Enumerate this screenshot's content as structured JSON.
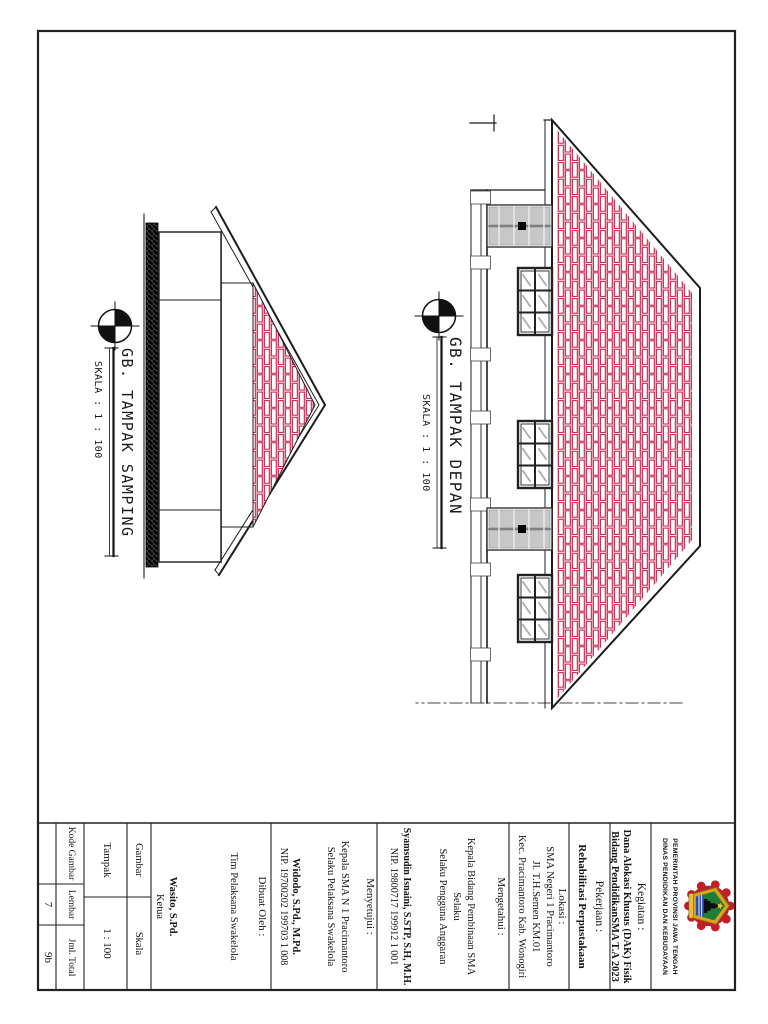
{
  "titleblock": {
    "agency": {
      "line1": "PEMERINTAH PROVINSI JAWA TENGAH",
      "line2": "DINAS PENDIDIKAN DAN KEBUDAYAAN"
    },
    "kegiatan": {
      "label": "Kegiatan :",
      "line1": "Dana Alokasi Khusus (DAK) Fisik",
      "line2": "Bidang PendidikanSMA T.A 2023"
    },
    "pekerjaan": {
      "label": "Pekerjaan :",
      "value": "Rehabilitasi Perpustakaan"
    },
    "lokasi": {
      "label": "Lokasi :",
      "line1": "SMA Negeri 1 Pracimantoro",
      "line2": "Jl. T.H.Semen KM.01",
      "line3": "Kec. Pracimantoro Kab. Wonogiri"
    },
    "mengetahui": {
      "label": "Mengetahui :",
      "role1": "Kepala Bidang Pembinaan SMA",
      "role2": "Selaku",
      "role3": "Selaku Pengguna Anggaran",
      "name": "Syamsudin Isnaini, S.STP, S.H, M.H.",
      "nip": "NIP. 19800717 199912 1 001"
    },
    "menyetujui": {
      "label": "Menyetujui :",
      "role1": "Kepala SMA N 1 Pracimantoro",
      "role2": "Selaku Pelaksana Swakelola",
      "name": "Widodo, S.Pd., M.Pd.",
      "nip": "NIP. 19700202 199703 1 008"
    },
    "dibuat": {
      "label": "Dibuat Oleh :",
      "team": "Tim Pelaksana Swakelola",
      "name": "Wasito, S.Pd.",
      "role": "Ketua"
    },
    "meta": {
      "gambar_label": "Gambar",
      "gambar_value": "Tampak",
      "skala_label": "Skala",
      "skala_value": "1 : 100",
      "kode_label": "Kode Gambar",
      "kode_value": "",
      "lembar_label": "Lembar",
      "lembar_value": "7",
      "jml_label": "Jml. Total",
      "jml_value": "9b"
    }
  },
  "drawings": {
    "depan": {
      "title": "GB. TAMPAK DEPAN",
      "scale": "SKALA : 1 : 100"
    },
    "samping": {
      "title": "GB. TAMPAK SAMPING",
      "scale": "SKALA : 1 : 100"
    }
  },
  "colors": {
    "line": "#1c1c1c",
    "brick_red": "#cd2850",
    "brick_pink": "#eda3b4",
    "door_gray": "#c7c7c7",
    "logo_red": "#c21e2a",
    "logo_gold": "#d9a520",
    "logo_green": "#1e7e38",
    "logo_blue": "#2a4fae"
  }
}
